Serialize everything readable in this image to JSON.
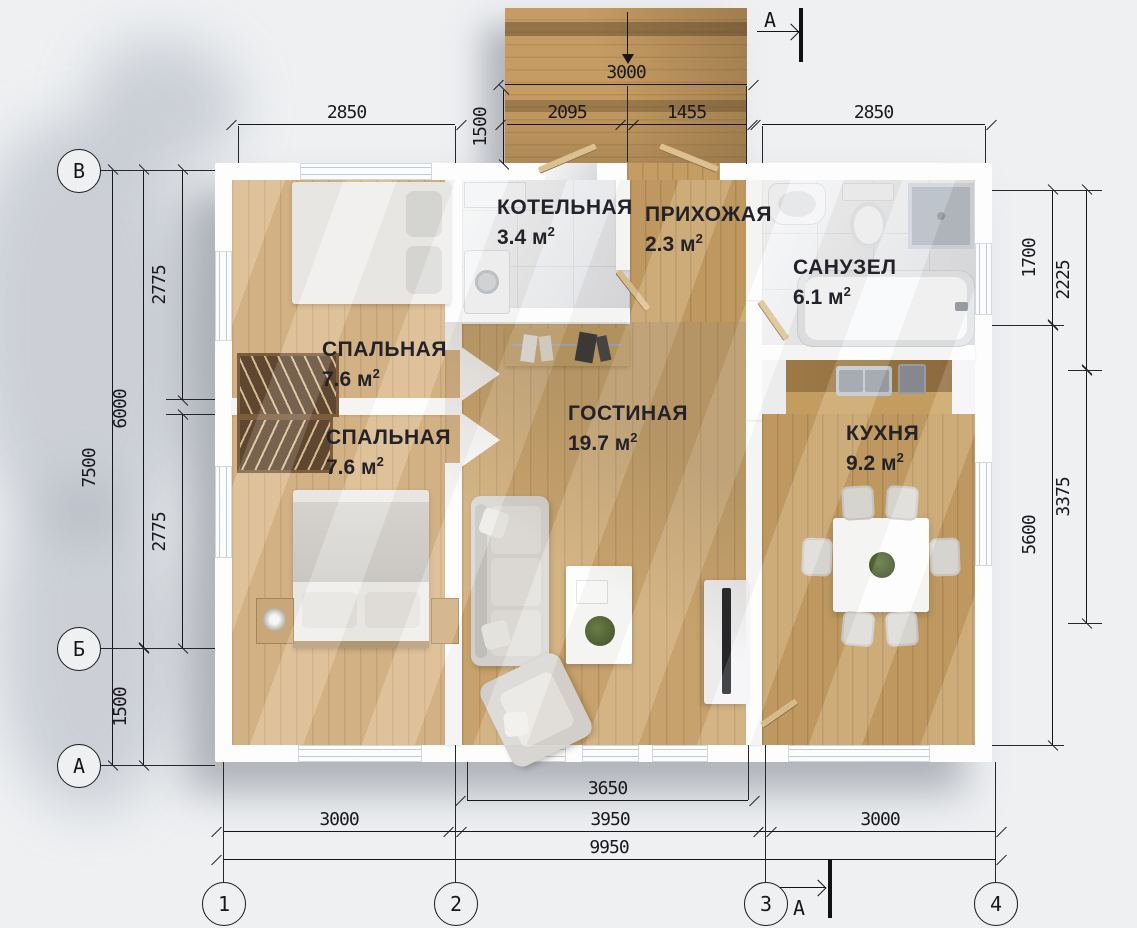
{
  "meta": {
    "sup": "2"
  },
  "axes": {
    "left": [
      "В",
      "Б",
      "А"
    ],
    "bottom": [
      "1",
      "2",
      "3",
      "4"
    ],
    "section_label": "А"
  },
  "rooms": {
    "boiler": {
      "label": "КОТЕЛЬНАЯ",
      "area": "3.4",
      "unit": "м"
    },
    "hallway": {
      "label": "ПРИХОЖАЯ",
      "area": "2.3",
      "unit": "м"
    },
    "bathroom": {
      "label": "САНУЗЕЛ",
      "area": "6.1",
      "unit": "м"
    },
    "bedroom_top": {
      "label": "СПАЛЬНАЯ",
      "area": "7.6",
      "unit": "м"
    },
    "bedroom_bottom": {
      "label": "СПАЛЬНАЯ",
      "area": "7.6",
      "unit": "м"
    },
    "living": {
      "label": "ГОСТИНАЯ",
      "area": "19.7",
      "unit": "м"
    },
    "kitchen": {
      "label": "КУХНЯ",
      "area": "9.2",
      "unit": "м"
    }
  },
  "dimensions": {
    "porch_width": "3000",
    "porch_depth": "1500",
    "top_left": "2850",
    "porch_seg_left": "2095",
    "porch_seg_right": "1455",
    "top_right": "2850",
    "left_total": "7500",
    "left_main": "6000",
    "left_lower": "1500",
    "left_room_top": "2775",
    "left_room_bottom": "2775",
    "right_bath": "1700",
    "right_bath_outer": "2225",
    "right_main": "5600",
    "right_kitchen": "3375",
    "bottom_windows": "3650",
    "bottom_left": "3000",
    "bottom_mid": "3950",
    "bottom_right": "3000",
    "bottom_total": "9950"
  },
  "colors": {
    "wood_light": "#d9b789",
    "wood_mid": "#cda76f",
    "deck": "#c59c63",
    "wall": "#fdfdfe",
    "marble": "#e9eaec",
    "line": "#17171b",
    "background": "#eef0f2"
  }
}
